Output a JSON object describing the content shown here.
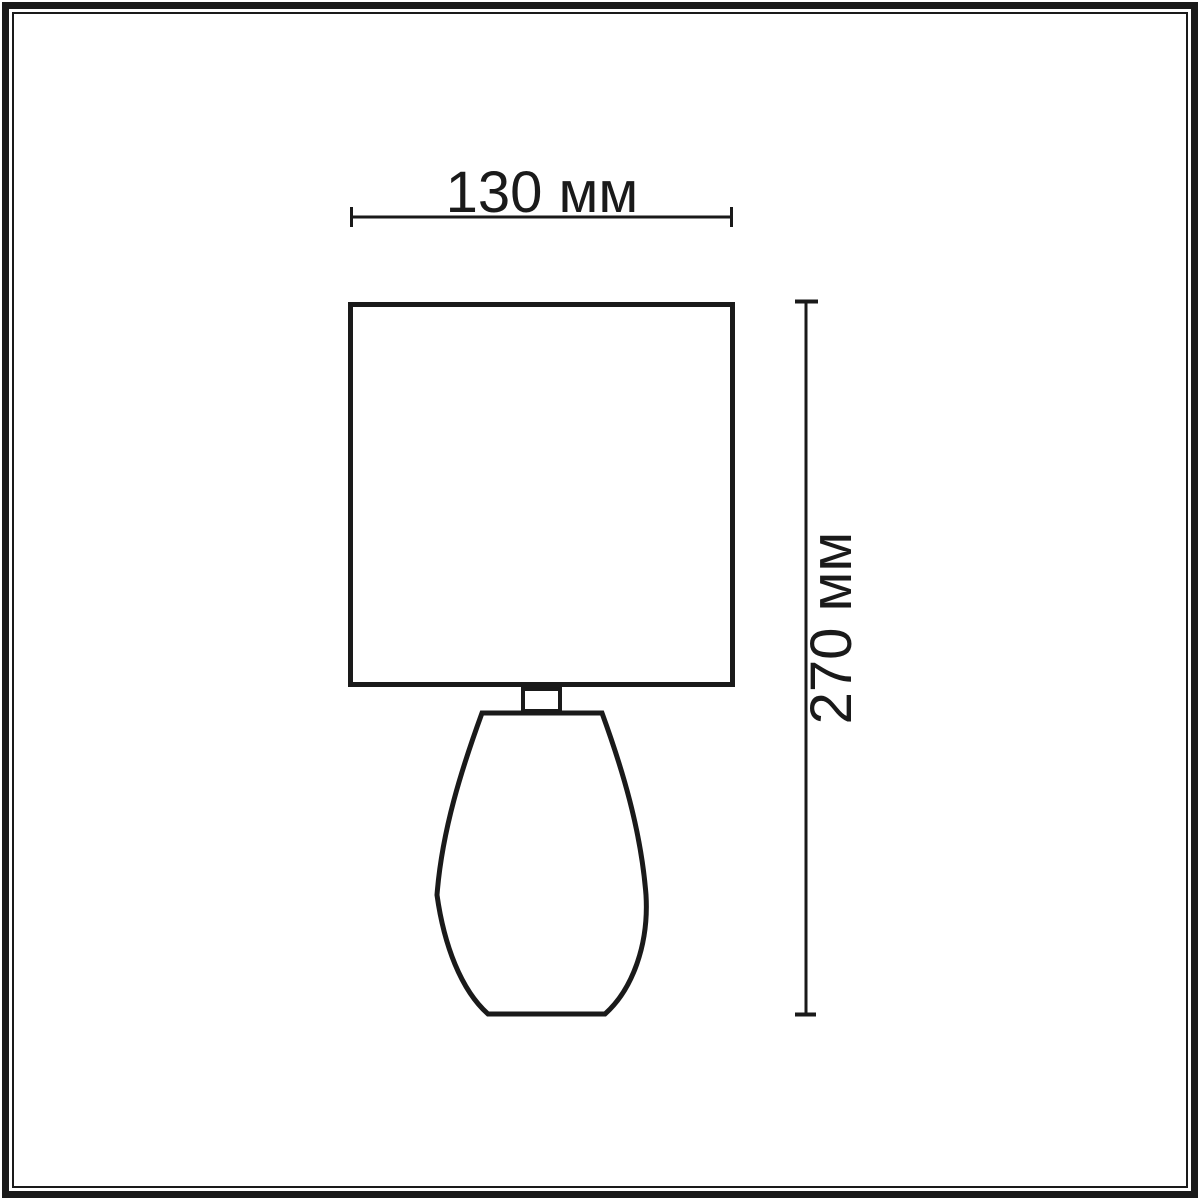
{
  "diagram": {
    "width_dimension": {
      "label": "130 мм"
    },
    "height_dimension": {
      "label": "270 мм"
    }
  },
  "colors": {
    "line": "#1a1a1a",
    "background": "#ffffff"
  }
}
